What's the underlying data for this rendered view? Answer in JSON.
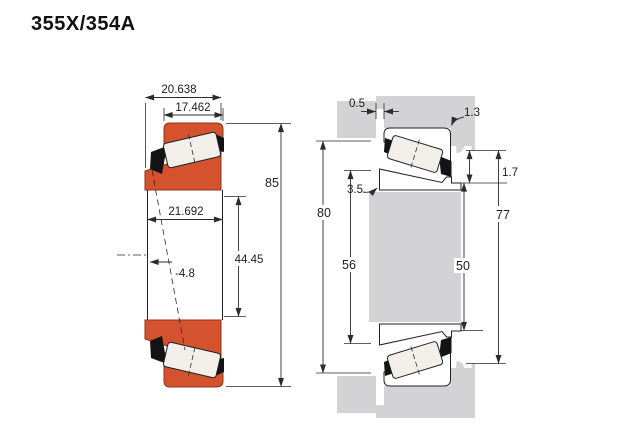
{
  "header": {
    "title": "355X/354A"
  },
  "colors": {
    "bearing_orange": "#d4532e",
    "bearing_orange_edge": "#8e3318",
    "steel_gray": "#d3d3d6",
    "roller_white": "#f2efea",
    "line": "#2b2b2b"
  },
  "left_view": {
    "name": "bearing cross-section",
    "dims": {
      "cone_width": "20.638",
      "cup_width": "17.462",
      "outer_diameter": "85",
      "overall_width": "21.692",
      "bore_diameter": "44.45",
      "load_center": "-4.8"
    }
  },
  "right_view": {
    "name": "mounting arrangement",
    "dims": {
      "side_clearance": "0.5",
      "housing_fillet": "1.3",
      "shaft_fillet": "3.5",
      "backing_ledge": "1.7",
      "housing_shoulder": "80",
      "housing_bore": "77",
      "shaft_shoulder": "56",
      "cone_backing": "50"
    }
  }
}
